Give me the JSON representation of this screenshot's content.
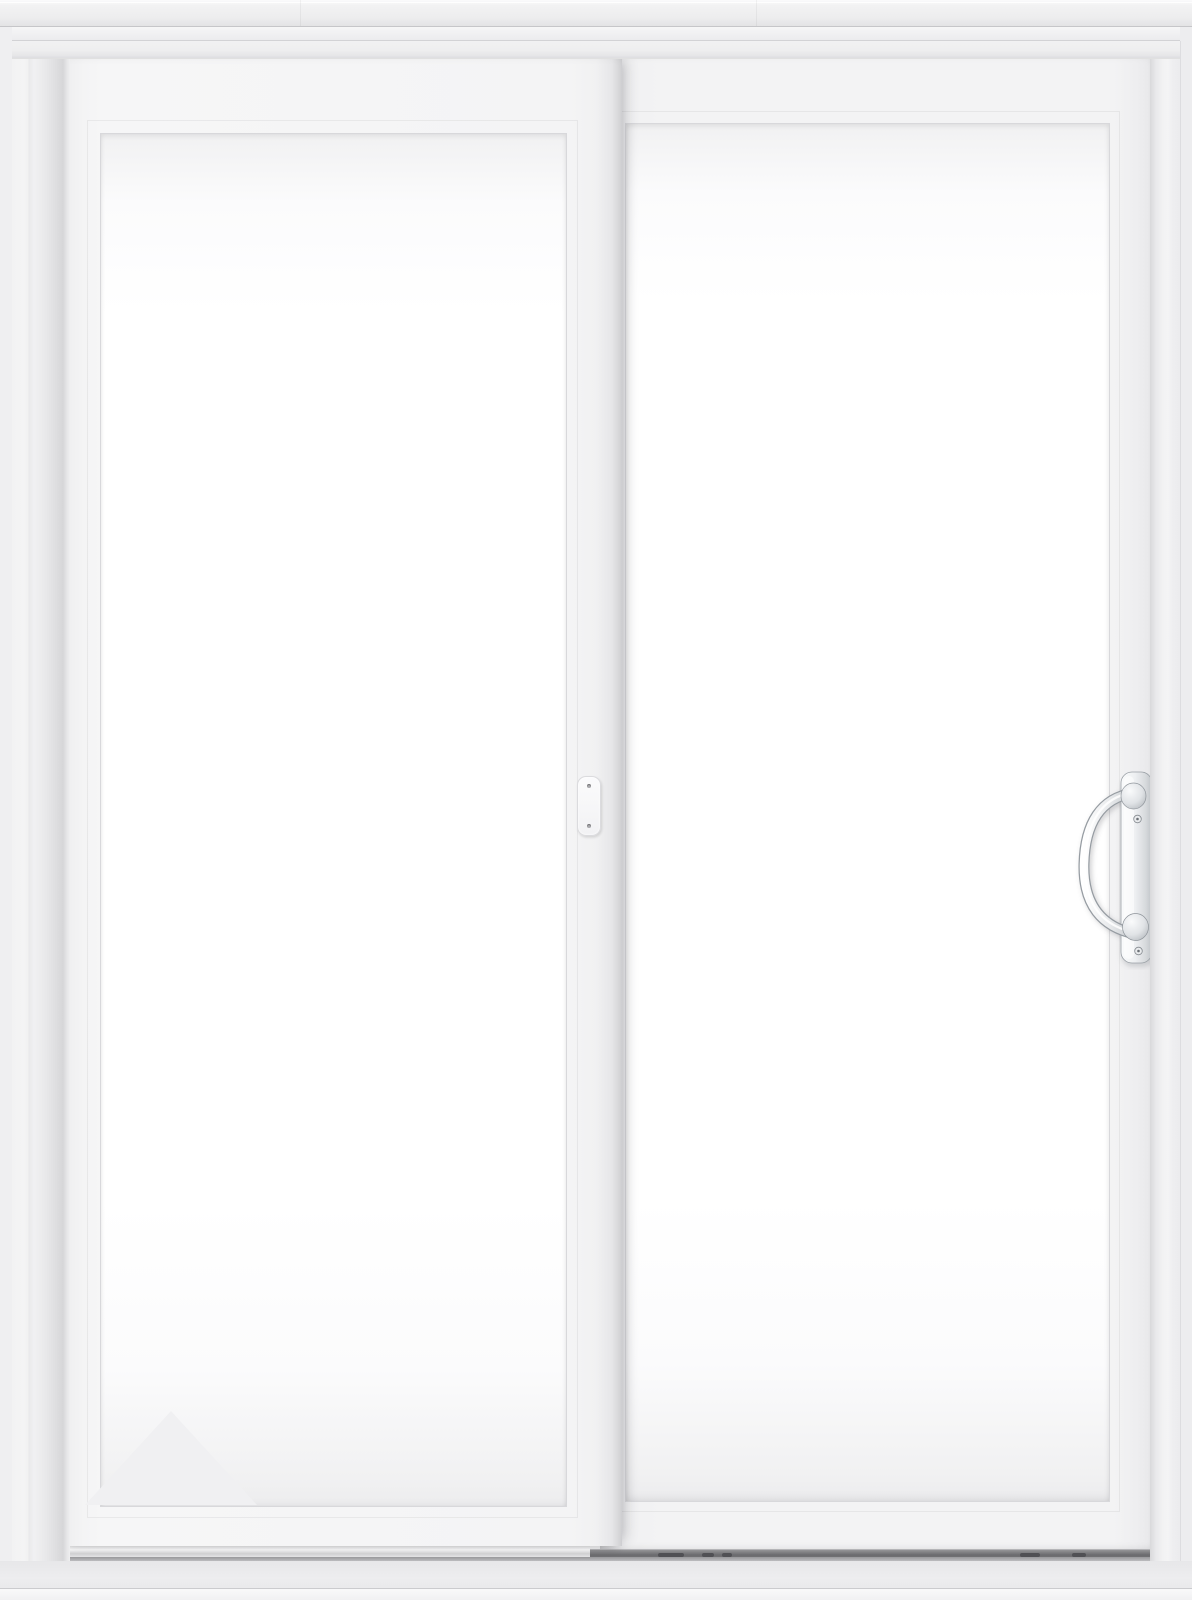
{
  "scene": {
    "description": "Straight-on product render of a white two-panel sliding glass patio door with clear glass",
    "door": {
      "type": "sliding-patio-door",
      "panel_count": 2,
      "left_panel": "front sliding panel with clear glass and interlock latch plate on its right stile",
      "right_panel": "rear panel with metallic exterior pull handle on its right stile",
      "frame": "white frame with head trim above and sill below",
      "glass": "clear, near-white with soft edge shading"
    },
    "hardware": {
      "handle": "silver metal D-style pull handle on rounded vertical backplate with two screws",
      "latch": "small white rounded latch plate with two screws at mid-height of center interlock stile",
      "track": "dark lower roller track with weep slots visible right of center; light track under front panel"
    },
    "watermark": "faint light-gray triangle reflection in the lower-left corner of the left glass pane"
  },
  "colors": {
    "page_bg": "#f2f2f3",
    "frame_white": "#f1f1f2",
    "panel_white": "#f4f4f5",
    "glass_white": "#ffffff",
    "glass_edge": "#ededee",
    "seam_shadow": "#d6d6d8",
    "outline_gray": "#c9c9cc",
    "track_dark": "#6b6b6e",
    "sill_gray": "#ebebed",
    "metal_light": "#f4f5f6",
    "metal_mid": "#c9ccd0",
    "metal_outline": "#9aa0a6",
    "watermark_gray": "#f0f0f2"
  }
}
